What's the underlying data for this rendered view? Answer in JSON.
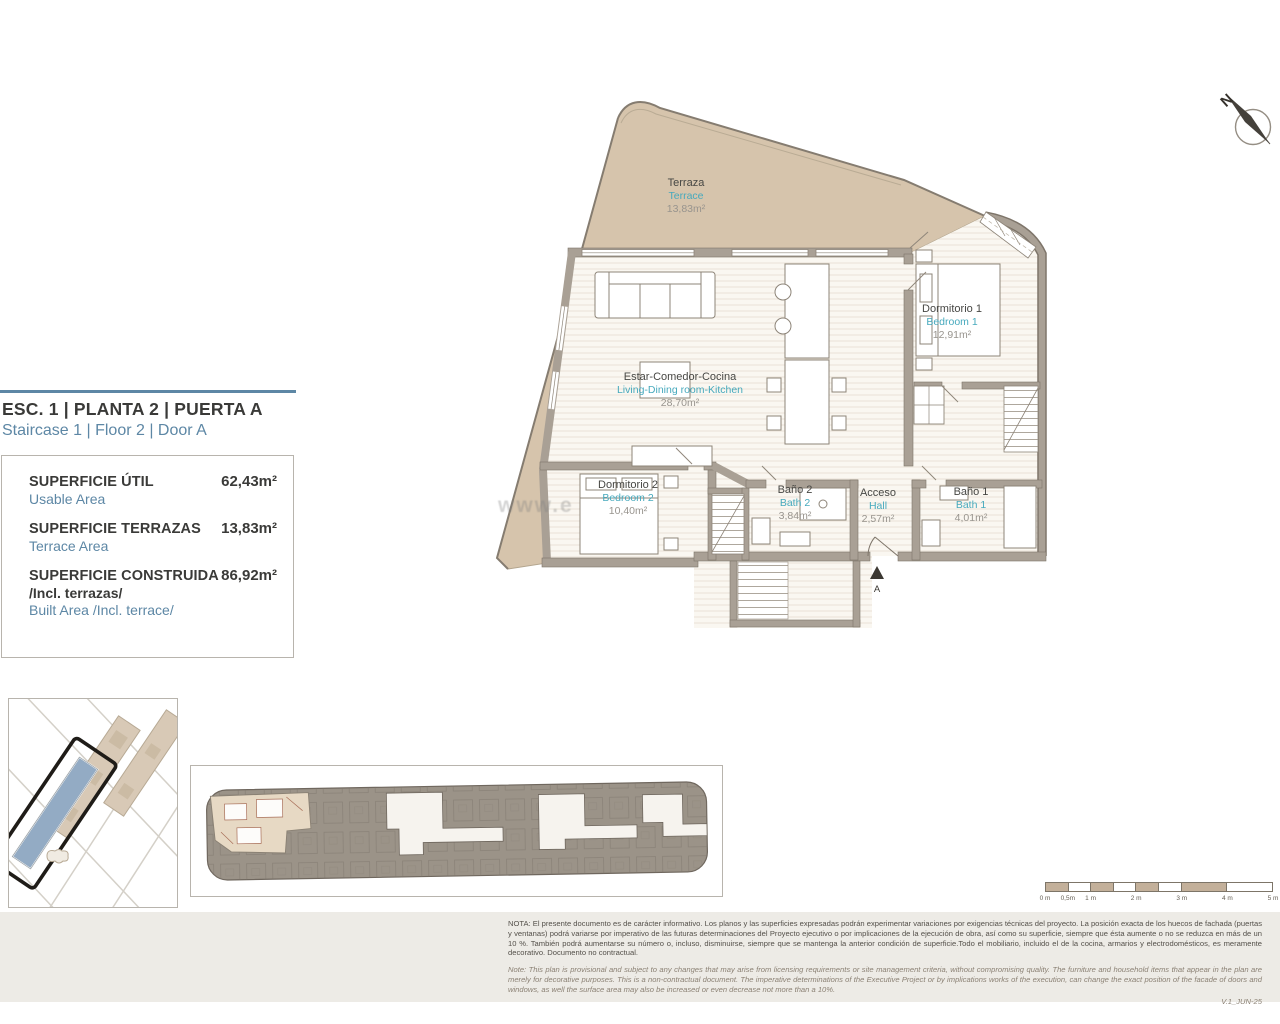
{
  "colors": {
    "accent": "#5d87a5",
    "teal": "#46a9bd",
    "terrace-tan": "#d6c4ac",
    "tan-dark": "#c3b09a",
    "wall": "#a9a095",
    "floor": "#faf7f1",
    "site-blue": "#93abc4"
  },
  "compass": {
    "north": "N"
  },
  "header": {
    "title": "ESC. 1 | PLANTA 2 | PUERTA A",
    "subtitle": "Staircase 1 | Floor 2 | Door A"
  },
  "area_table": {
    "rows": [
      {
        "label": "SUPERFICIE ÚTIL",
        "sublabel": "Usable Area",
        "value": "62,43m²"
      },
      {
        "label": "SUPERFICIE TERRAZAS",
        "sublabel": "Terrace Area",
        "value": "13,83m²"
      },
      {
        "label": "SUPERFICIE CONSTRUIDA",
        "label_extra": "/Incl. terrazas/",
        "sublabel": "Built Area /Incl. terrace/",
        "value": "86,92m²"
      }
    ]
  },
  "floor_plan": {
    "watermark": "www.e",
    "entry_marker": "A",
    "rooms": [
      {
        "name_es": "Terraza",
        "name_en": "Terrace",
        "area": "13,83m²"
      },
      {
        "name_es": "Estar-Comedor-Cocina",
        "name_en": "Living-Dining room-Kitchen",
        "area": "28,70m²"
      },
      {
        "name_es": "Dormitorio 1",
        "name_en": "Bedroom 1",
        "area": "12,91m²"
      },
      {
        "name_es": "Dormitorio 2",
        "name_en": "Bedroom 2",
        "area": "10,40m²"
      },
      {
        "name_es": "Baño 2",
        "name_en": "Bath 2",
        "area": "3,84m²"
      },
      {
        "name_es": "Acceso",
        "name_en": "Hall",
        "area": "2,57m²"
      },
      {
        "name_es": "Baño 1",
        "name_en": "Bath 1",
        "area": "4,01m²"
      }
    ]
  },
  "scale_bar": {
    "labels": [
      "0 m",
      "0,5m",
      "1 m",
      "2 m",
      "3 m",
      "4 m",
      "5 m"
    ]
  },
  "notes": {
    "es": "NOTA: El presente documento es de carácter informativo. Los planos y las superficies expresadas podrán experimentar variaciones por exigencias técnicas del proyecto. La posición exacta de los huecos de fachada (puertas y ventanas) podrá variarse por imperativo de las futuras determinaciones del Proyecto ejecutivo o por implicaciones de la ejecución de obra, así como su superficie, siempre que ésta aumente o no se reduzca en más de un 10 %. También podrá aumentarse su número o, incluso, disminuirse, siempre que se mantenga la anterior condición de superficie.Todo el mobiliario, incluido el de la cocina, armarios y electrodomésticos, es meramente decorativo. Documento no contractual.",
    "en": "Note: This plan is provisional and subject to any changes that may arise from licensing requirements or site management criteria, without compromising quality. The furniture and household items that appear in the plan are merely for decorative purposes. This is a non-contractual document. The imperative determinations of the Executive Project or by implications works of the execution, can change the exact position of the facade of doors and windows, as well the surface area may also be increased or even decrease not more than a 10%.",
    "version": "V.1_JUN-25"
  }
}
